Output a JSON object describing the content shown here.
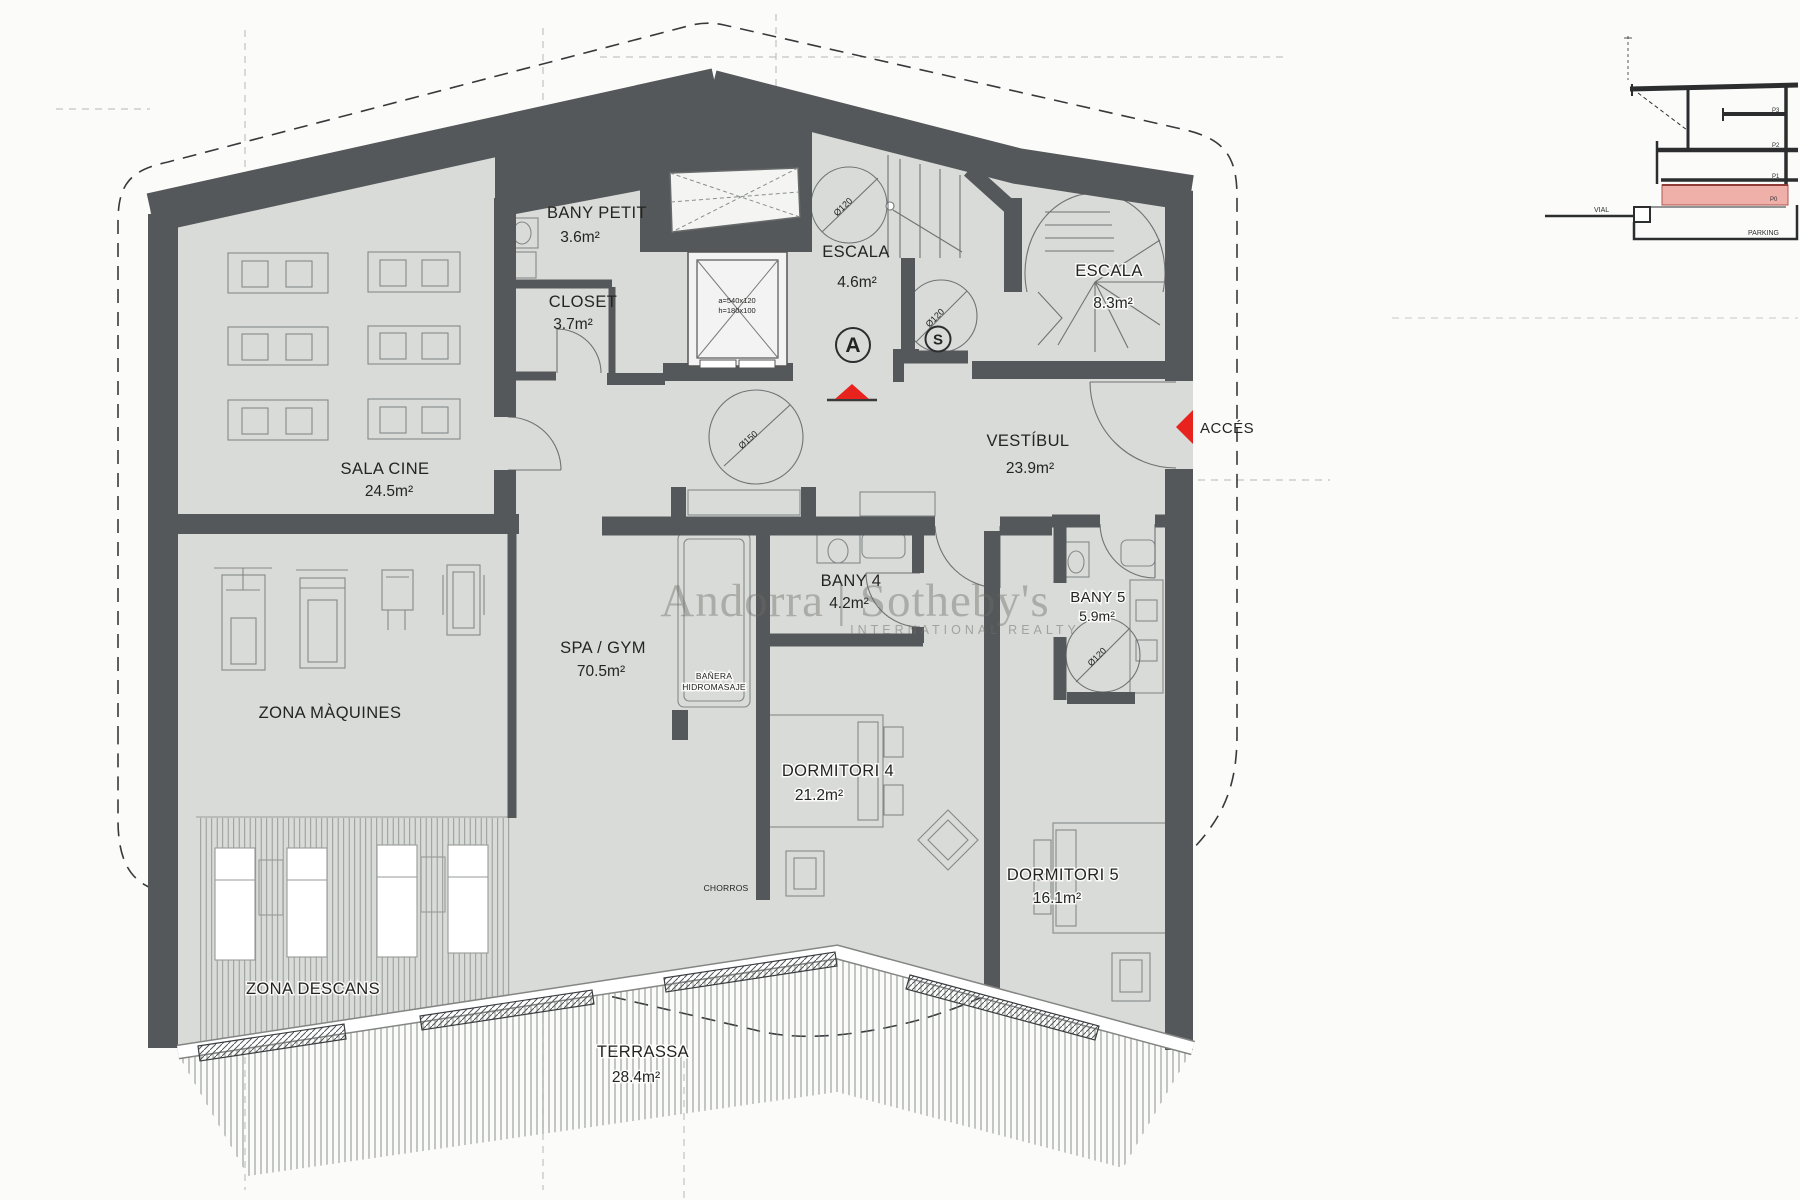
{
  "rooms": {
    "sala_cine": {
      "name": "SALA CINE",
      "area": "24.5m²"
    },
    "bany_petit": {
      "name": "BANY PETIT",
      "area": "3.6m²"
    },
    "closet": {
      "name": "CLOSET",
      "area": "3.7m²"
    },
    "escala_a": {
      "name": "ESCALA",
      "area": "4.6m²"
    },
    "escala_b": {
      "name": "ESCALA",
      "area": "8.3m²"
    },
    "vestibul": {
      "name": "VESTÍBUL",
      "area": "23.9m²"
    },
    "zona_maquines": {
      "name": "ZONA MÀQUINES"
    },
    "spa_gym": {
      "name": "SPA / GYM",
      "area": "70.5m²"
    },
    "bany_4": {
      "name": "BANY 4",
      "area": "4.2m²"
    },
    "bany_5": {
      "name": "BANY 5",
      "area": "5.9m²"
    },
    "dormitori_4": {
      "name": "DORMITORI 4",
      "area": "21.2m²"
    },
    "dormitori_5": {
      "name": "DORMITORI 5",
      "area": "16.1m²"
    },
    "zona_descans": {
      "name": "ZONA DESCANS"
    },
    "terrassa": {
      "name": "TERRASSA",
      "area": "28.4m²"
    }
  },
  "annotations": {
    "acces": "ACCÉS",
    "stair_badge_a": "A",
    "stair_badge_s": "S",
    "turning_circle_120": "Ø120",
    "turning_circle_150": "Ø150",
    "elevator_dim_1": "a=540x120",
    "elevator_dim_2": "h=180x100",
    "banyera_line1": "BAÑERA",
    "banyera_line2": "HIDROMASAJE",
    "chorros": "CHORROS"
  },
  "watermark": {
    "main": "Andorra | Sotheby's",
    "sub": "INTERNATIONAL REALTY"
  },
  "section_inset": {
    "street_label": "VIAL",
    "parking_label": "PARKING",
    "floor_labels": [
      "P3",
      "P2",
      "P1",
      "P0"
    ]
  },
  "colors": {
    "wall": "#55585a",
    "floor": "#d9dbd8",
    "accent_red": "#e8231d",
    "section_highlight": "#f0b0aa",
    "line": "#85898a",
    "text": "#242422"
  }
}
